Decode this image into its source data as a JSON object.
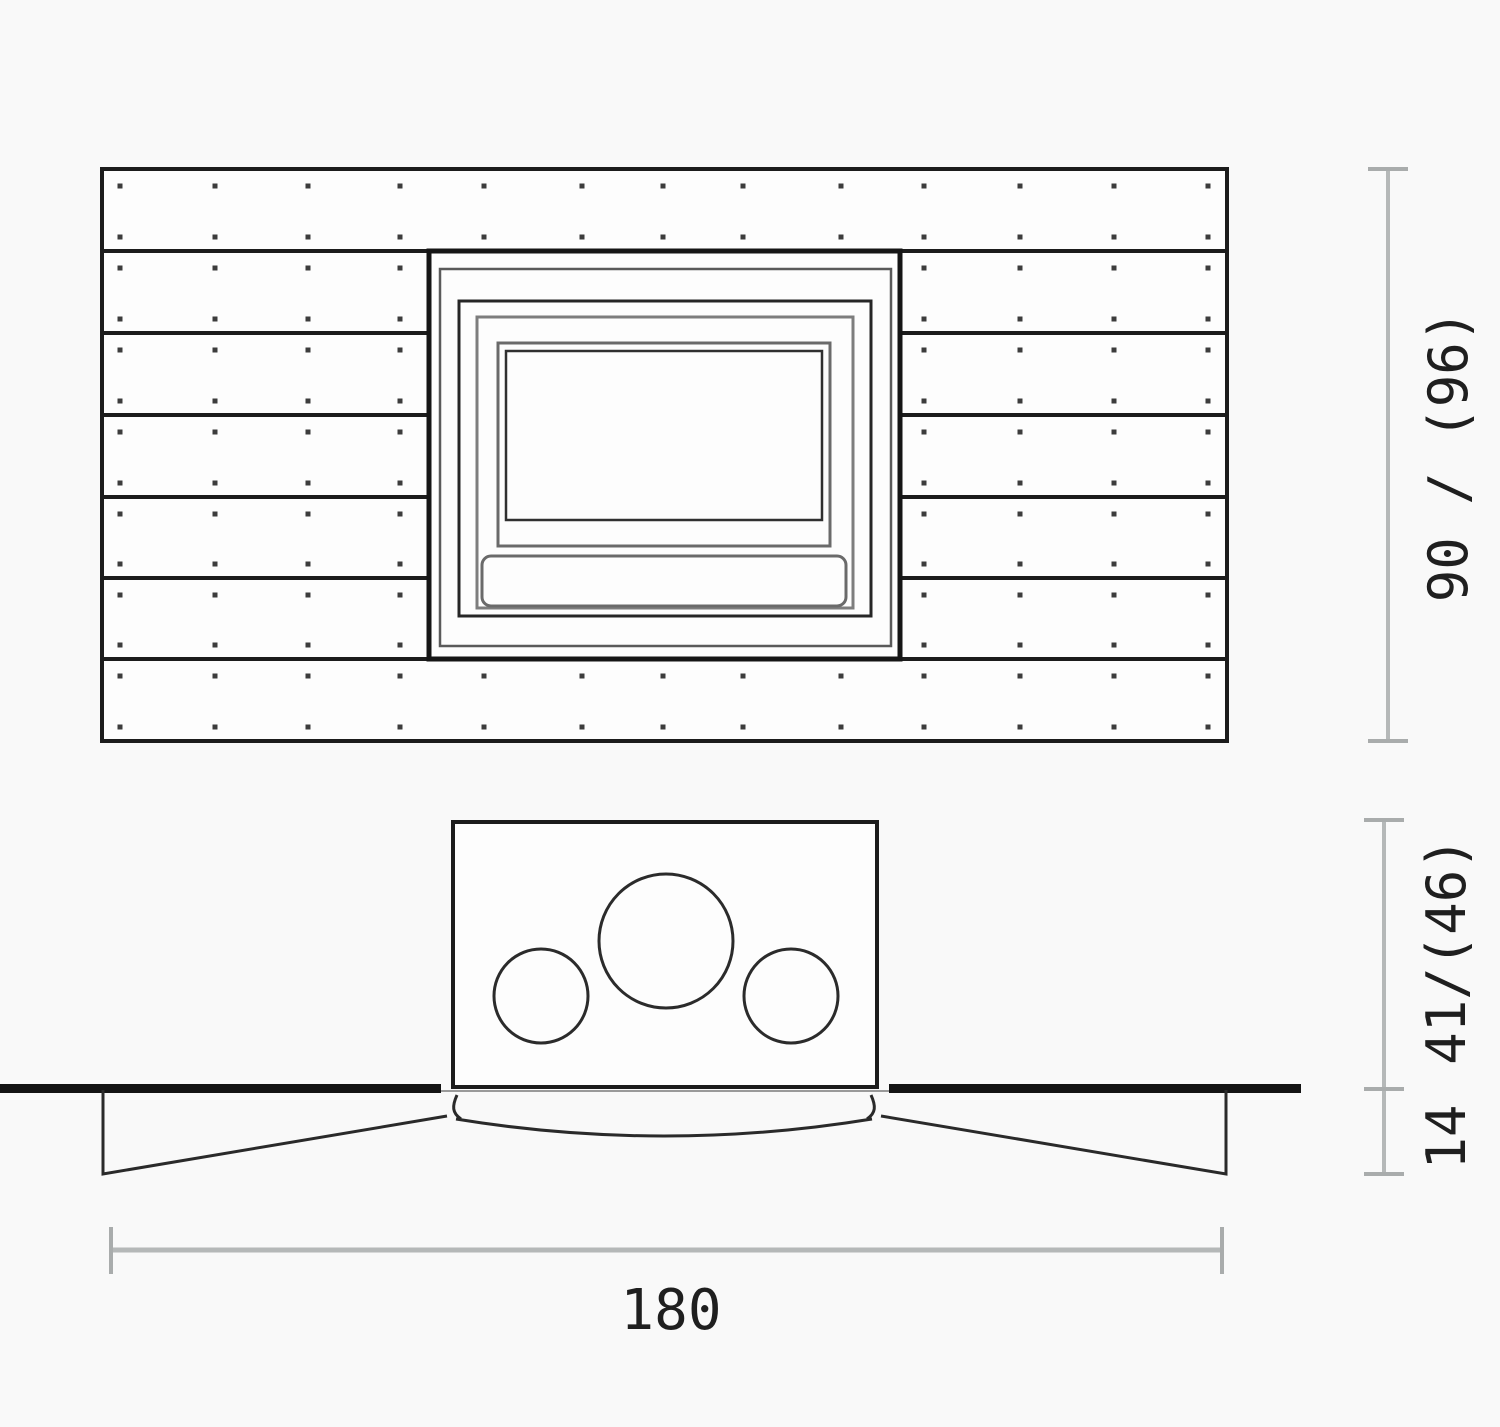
{
  "front_view": {
    "dim_height_label": "90 / (96)",
    "planks": {
      "row_boundaries": [
        169,
        251,
        333,
        415,
        497,
        578,
        659,
        741
      ],
      "full_row_indices": [
        0,
        6
      ],
      "panel_left": 102,
      "panel_right": 1227,
      "screw_columns_full": [
        120,
        215,
        308,
        400,
        484,
        582,
        663,
        743,
        841,
        924,
        1020,
        1114,
        1208
      ],
      "screw_columns_left": [
        120,
        215,
        308,
        400
      ],
      "screw_columns_right": [
        924,
        1020,
        1114,
        1208
      ],
      "screw_top_offset": 17,
      "screw_bottom_offset": 14,
      "screw_size": 5
    }
  },
  "plan_view": {
    "dim_depth_upper_label": "41/(46)",
    "dim_depth_lower_label": "14",
    "dim_width_label": "180"
  },
  "colors": {
    "line_dark": "#1c1c1c",
    "line_mid": "#2b2b2b",
    "frame_gray": "#6f6f6f",
    "frame_light_gray": "#8a8a8a",
    "dim_line": "#b5b8b8",
    "dim_tick": "#a9acac",
    "text": "#1f1f1f",
    "screw": "#3c3c3c",
    "fill": "#fdfdfd"
  }
}
